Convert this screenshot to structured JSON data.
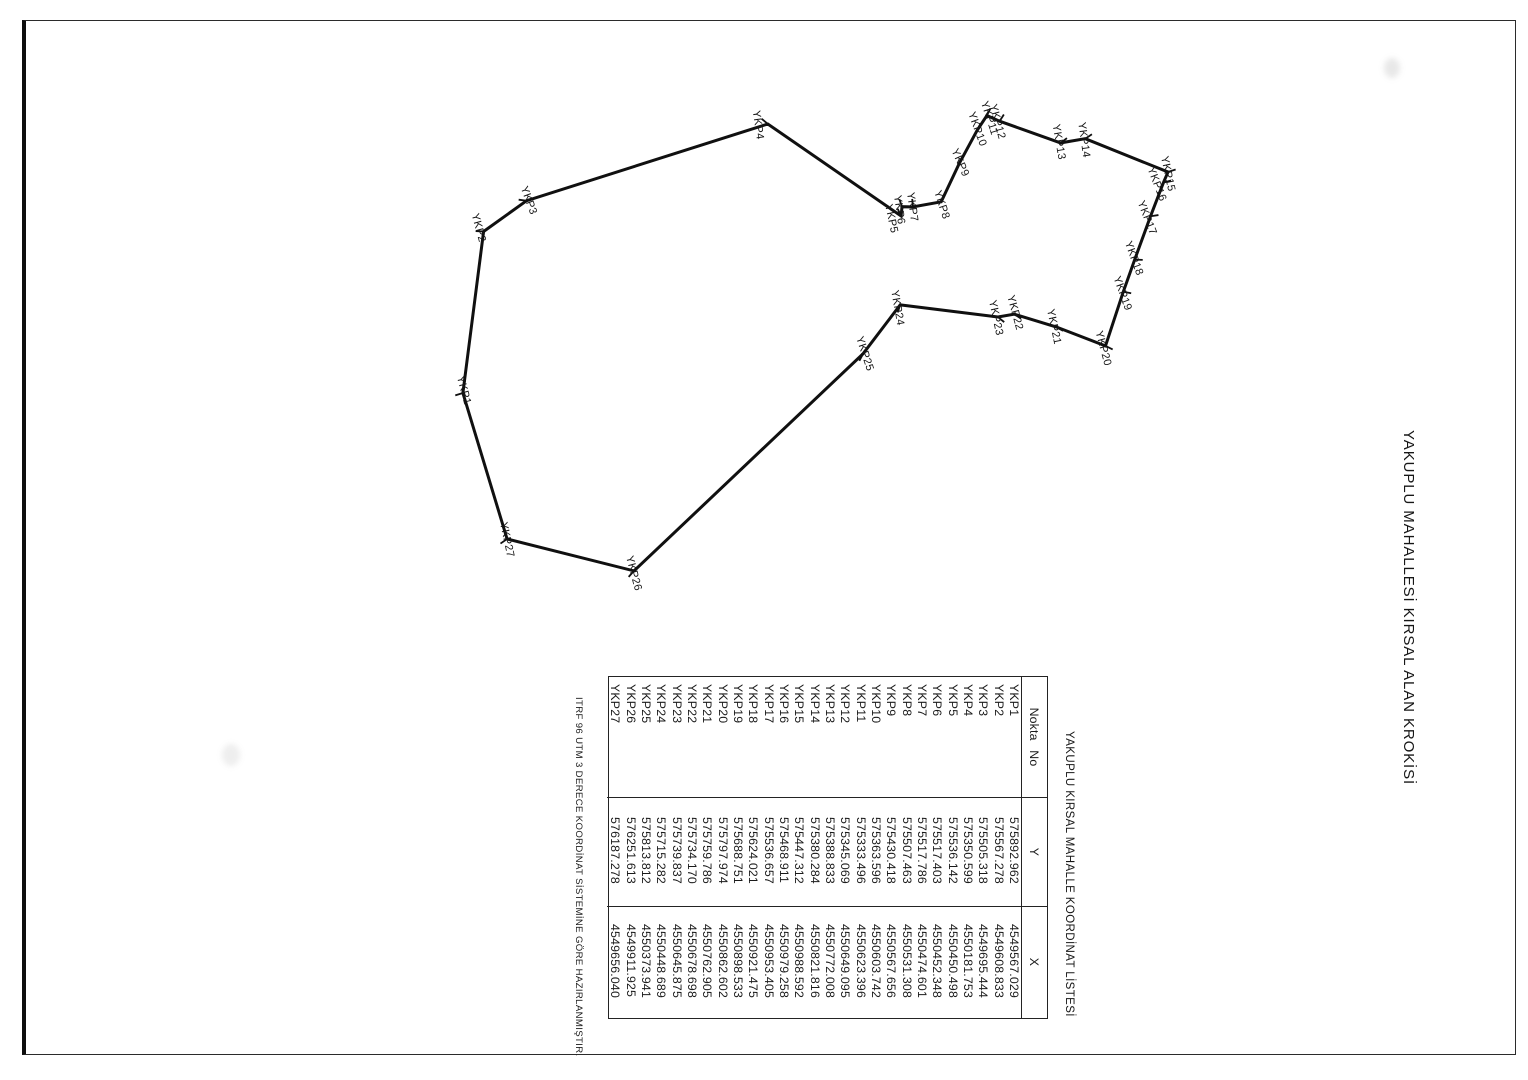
{
  "page": {
    "title": "YAKUPLU MAHALLESİ KIRSAL ALAN KROKİSİ",
    "note": "ITRF 96 UTM 3 DERECE KOORDİNAT SİSTEMİNE GÖRE HAZIRLANMIŞTIR.",
    "ink_color": "#1a1a1a",
    "paper_color": "#ffffff"
  },
  "table": {
    "title": "YAKUPLU KIRSAL MAHALLE KOORDİNAT LİSTESİ",
    "headers": {
      "no": "Nokta No",
      "y": "Y",
      "x": "X"
    },
    "rows": [
      {
        "no": "YKP1",
        "y": "575892.962",
        "x": "4549567.029"
      },
      {
        "no": "YKP2",
        "y": "575567.278",
        "x": "4549608.833"
      },
      {
        "no": "YKP3",
        "y": "575505.318",
        "x": "4549695.444"
      },
      {
        "no": "YKP4",
        "y": "575350.599",
        "x": "4550181.753"
      },
      {
        "no": "YKP5",
        "y": "575536.142",
        "x": "4550450.498"
      },
      {
        "no": "YKP6",
        "y": "575517.403",
        "x": "4550452.348"
      },
      {
        "no": "YKP7",
        "y": "575517.786",
        "x": "4550474.601"
      },
      {
        "no": "YKP8",
        "y": "575507.463",
        "x": "4550531.308"
      },
      {
        "no": "YKP9",
        "y": "575430.418",
        "x": "4550567.656"
      },
      {
        "no": "YKP10",
        "y": "575363.596",
        "x": "4550603.742"
      },
      {
        "no": "YKP11",
        "y": "575333.496",
        "x": "4550623.396"
      },
      {
        "no": "YKP12",
        "y": "575345.069",
        "x": "4550649.095"
      },
      {
        "no": "YKP13",
        "y": "575388.833",
        "x": "4550772.008"
      },
      {
        "no": "YKP14",
        "y": "575380.284",
        "x": "4550821.816"
      },
      {
        "no": "YKP15",
        "y": "575447.312",
        "x": "4550988.592"
      },
      {
        "no": "YKP16",
        "y": "575468.911",
        "x": "4550979.258"
      },
      {
        "no": "YKP17",
        "y": "575536.657",
        "x": "4550953.405"
      },
      {
        "no": "YKP18",
        "y": "575624.021",
        "x": "4550921.475"
      },
      {
        "no": "YKP19",
        "y": "575688.751",
        "x": "4550898.533"
      },
      {
        "no": "YKP20",
        "y": "575797.974",
        "x": "4550862.602"
      },
      {
        "no": "YKP21",
        "y": "575759.786",
        "x": "4550762.905"
      },
      {
        "no": "YKP22",
        "y": "575734.170",
        "x": "4550678.698"
      },
      {
        "no": "YKP23",
        "y": "575739.837",
        "x": "4550645.875"
      },
      {
        "no": "YKP24",
        "y": "575715.282",
        "x": "4550448.689"
      },
      {
        "no": "YKP25",
        "y": "575813.812",
        "x": "4550373.941"
      },
      {
        "no": "YKP26",
        "y": "576251.613",
        "x": "4549911.925"
      },
      {
        "no": "YKP27",
        "y": "576187.278",
        "x": "4549656.040"
      }
    ]
  }
}
